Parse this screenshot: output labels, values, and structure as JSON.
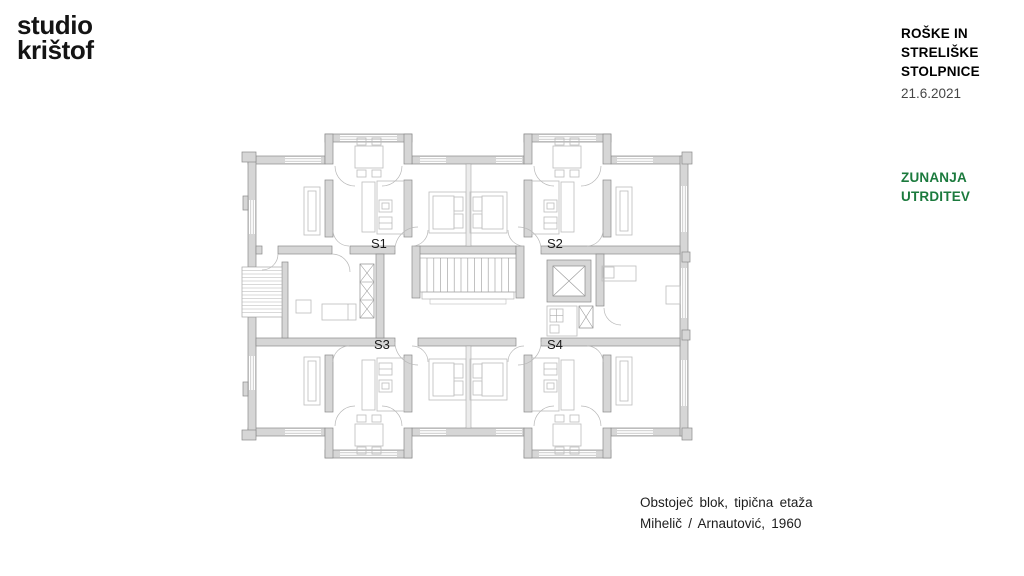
{
  "logo": {
    "line1": "studio",
    "line2": "krištof"
  },
  "header": {
    "title_lines": [
      "ROŠKE IN",
      "STRELIŠKE",
      "STOLPNICE"
    ],
    "date": "21.6.2021"
  },
  "side_label": {
    "lines": [
      "ZUNANJA",
      "UTRDITEV"
    ],
    "color": "#1b7a3d"
  },
  "caption": {
    "line1": "Obstoječ blok, tipična etaža",
    "line2": "Mihelič / Arnautović, 1960"
  },
  "floor_plan": {
    "units": [
      "S1",
      "S2",
      "S3",
      "S4"
    ],
    "colors": {
      "wall_fill": "#d6d6d6",
      "wall_stroke": "#8a8a8a",
      "furniture_stroke": "#bdbdbd",
      "label": "#1a1a1a"
    }
  }
}
